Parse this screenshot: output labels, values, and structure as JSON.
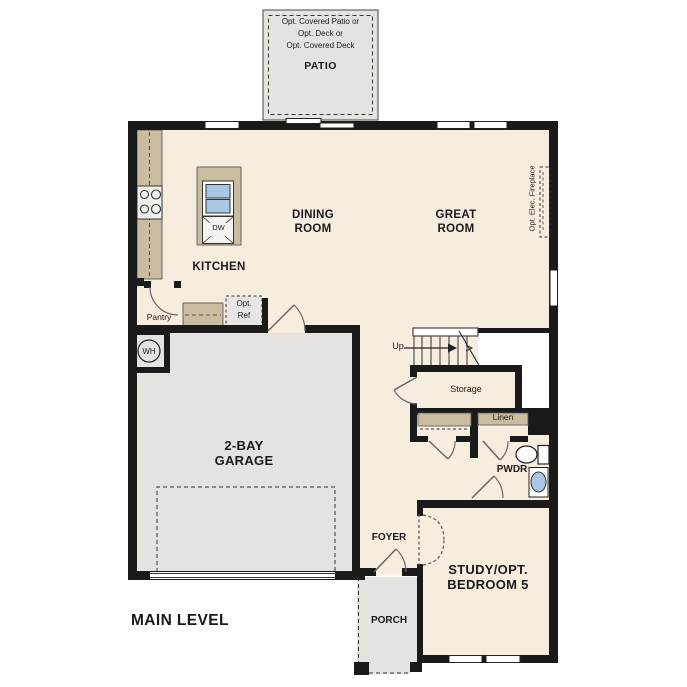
{
  "title": {
    "label": "MAIN LEVEL"
  },
  "patio": {
    "notes": "Opt. Covered Patio or\nOpt. Deck or\nOpt. Covered Deck",
    "label": "PATIO"
  },
  "rooms": {
    "dining": "DINING\nROOM",
    "great": "GREAT\nROOM",
    "kitchen": "KITCHEN",
    "garage": "2-BAY\nGARAGE",
    "foyer": "FOYER",
    "porch": "PORCH",
    "study": "STUDY/OPT.\nBEDROOM 5",
    "pwdr": "PWDR",
    "storage": "Storage",
    "pantry": "Pantry",
    "linen": "Linen"
  },
  "fixtures": {
    "dishwasher": "DW",
    "water_heater": "WH",
    "opt_ref": "Opt.\nRef",
    "fireplace": "Opt. Elec. Fireplace",
    "stairs_up": "Up"
  },
  "colors": {
    "interior_floor": "#f6eddf",
    "counter_tan": "#c9bca0",
    "concrete_gray": "#e4e3e0",
    "wall_black": "#1a1a1a",
    "sink_blue": "#a9c7e5"
  }
}
